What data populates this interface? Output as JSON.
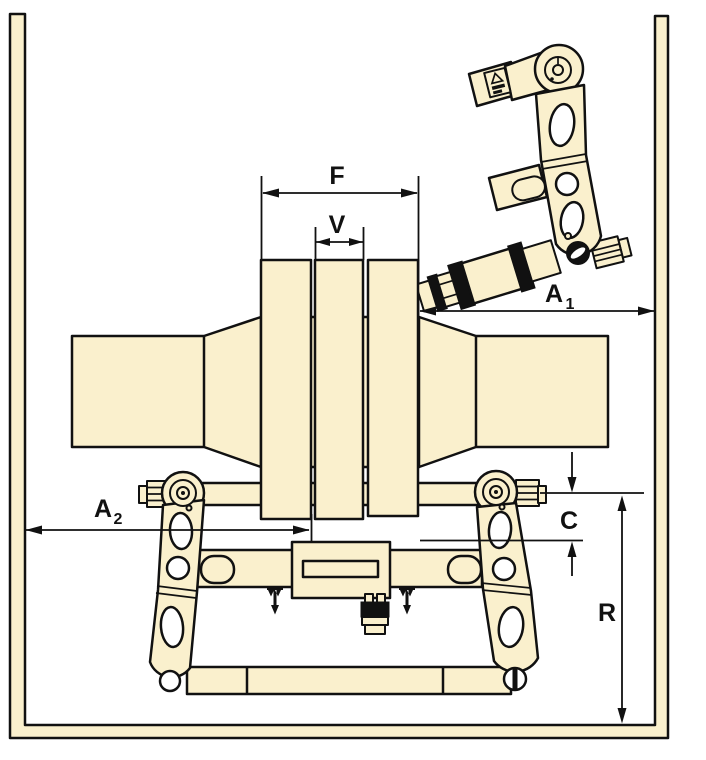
{
  "colors": {
    "part_fill": "#FAF0CD",
    "line": "#111111",
    "background": "#FFFFFF"
  },
  "dimension_labels": {
    "f": {
      "main": "F"
    },
    "v": {
      "main": "V"
    },
    "a1": {
      "main": "A",
      "sub": "1"
    },
    "a2": {
      "main": "A",
      "sub": "2"
    },
    "c": {
      "main": "C"
    },
    "r": {
      "main": "R"
    }
  }
}
